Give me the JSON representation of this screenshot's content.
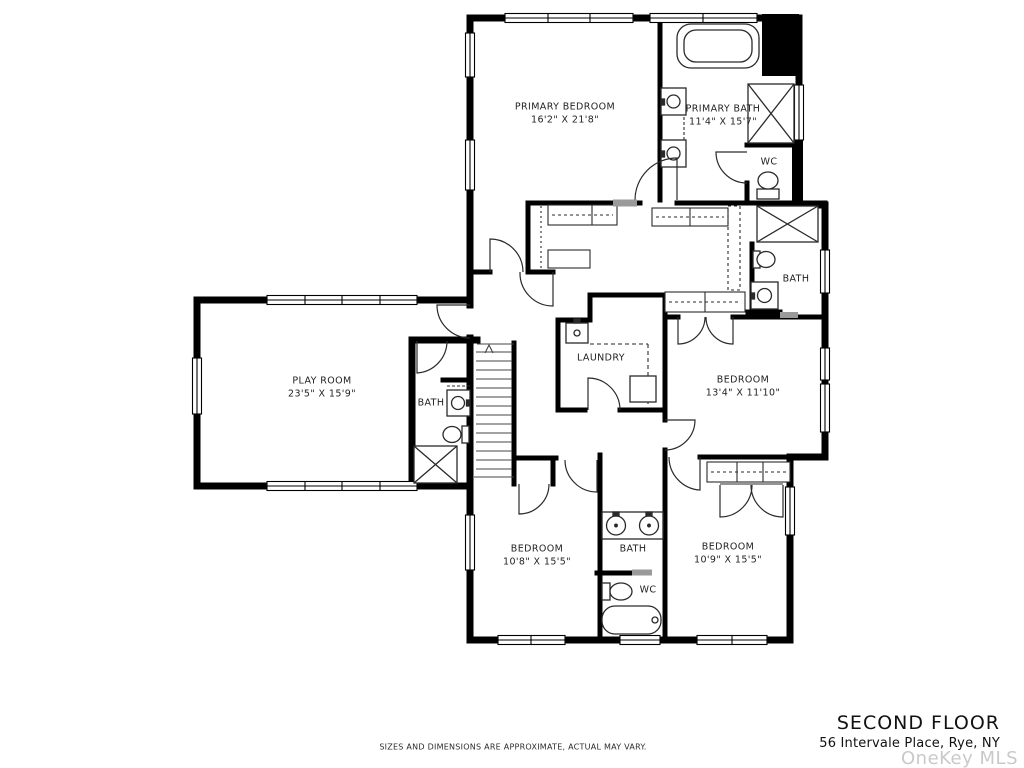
{
  "plan": {
    "rooms": {
      "primary_bedroom": {
        "name": "PRIMARY BEDROOM",
        "dims": "16'2\" X 21'8\""
      },
      "primary_bath": {
        "name": "PRIMARY BATH",
        "dims": "11'4\" X 15'7\""
      },
      "wc_top": {
        "name": "WC"
      },
      "bath_right": {
        "name": "BATH"
      },
      "play_room": {
        "name": "PLAY ROOM",
        "dims": "23'5\" X 15'9\""
      },
      "bath_left": {
        "name": "BATH"
      },
      "laundry": {
        "name": "LAUNDRY"
      },
      "bedroom_right": {
        "name": "BEDROOM",
        "dims": "13'4\" X 11'10\""
      },
      "bedroom_bottom_left": {
        "name": "BEDROOM",
        "dims": "10'8\" X 15'5\""
      },
      "bath_bottom": {
        "name": "BATH"
      },
      "wc_bottom": {
        "name": "WC"
      },
      "bedroom_bottom_right": {
        "name": "BEDROOM",
        "dims": "10'9\" X 15'5\""
      }
    }
  },
  "footer": {
    "disclaimer": "SIZES AND DIMENSIONS ARE APPROXIMATE, ACTUAL MAY VARY.",
    "title": "SECOND FLOOR",
    "address": "56 Intervale Place, Rye, NY",
    "watermark": "OneKey MLS"
  },
  "colors": {
    "wall": "#000000",
    "fixture_line": "#2a2a2a",
    "gray_bar": "#9a9a9a",
    "watermark": "#c9c9c9"
  }
}
